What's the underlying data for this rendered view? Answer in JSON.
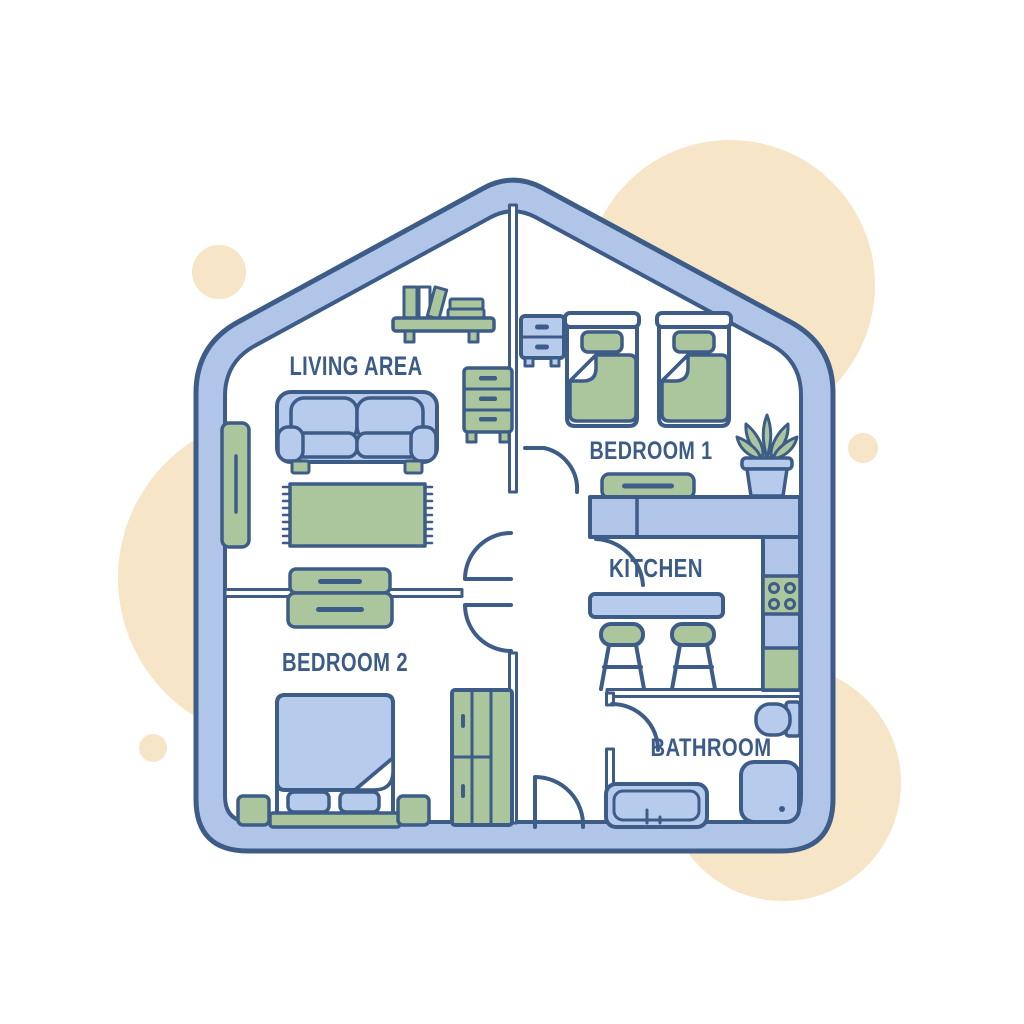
{
  "illustration": {
    "title": "House floor plan illustration",
    "style": "flat line-art floor plan inside a house-shaped (pentagon) outline with beige accent circles",
    "rooms": [
      {
        "id": "living-area",
        "label": "LIVING AREA",
        "furniture": [
          "wall shelf with books",
          "sofa",
          "fringed rug",
          "tall cabinet",
          "chest of drawers",
          "two sideboards"
        ]
      },
      {
        "id": "bedroom-1",
        "label": "BEDROOM 1",
        "furniture": [
          "nightstand with two drawers",
          "twin bed",
          "twin bed",
          "bench",
          "potted plant"
        ]
      },
      {
        "id": "kitchen",
        "label": "KITCHEN",
        "furniture": [
          "counter",
          "stove with four burners",
          "breakfast bar",
          "stool",
          "stool"
        ]
      },
      {
        "id": "bedroom-2",
        "label": "BEDROOM 2",
        "furniture": [
          "double bed with two pillows",
          "nightstand",
          "nightstand",
          "wardrobe"
        ]
      },
      {
        "id": "bathroom",
        "label": "BATHROOM",
        "furniture": [
          "toilet",
          "bathtub",
          "shower"
        ]
      }
    ],
    "palette": {
      "background": "#ffffff",
      "beige_accent": "#f6e5c6",
      "wall_blue": "#b0c5e8",
      "furniture_blue": "#b7cbed",
      "furniture_green": "#abc69d",
      "outline_navy": "#3d5c87",
      "label_navy": "#3c5b86"
    }
  }
}
